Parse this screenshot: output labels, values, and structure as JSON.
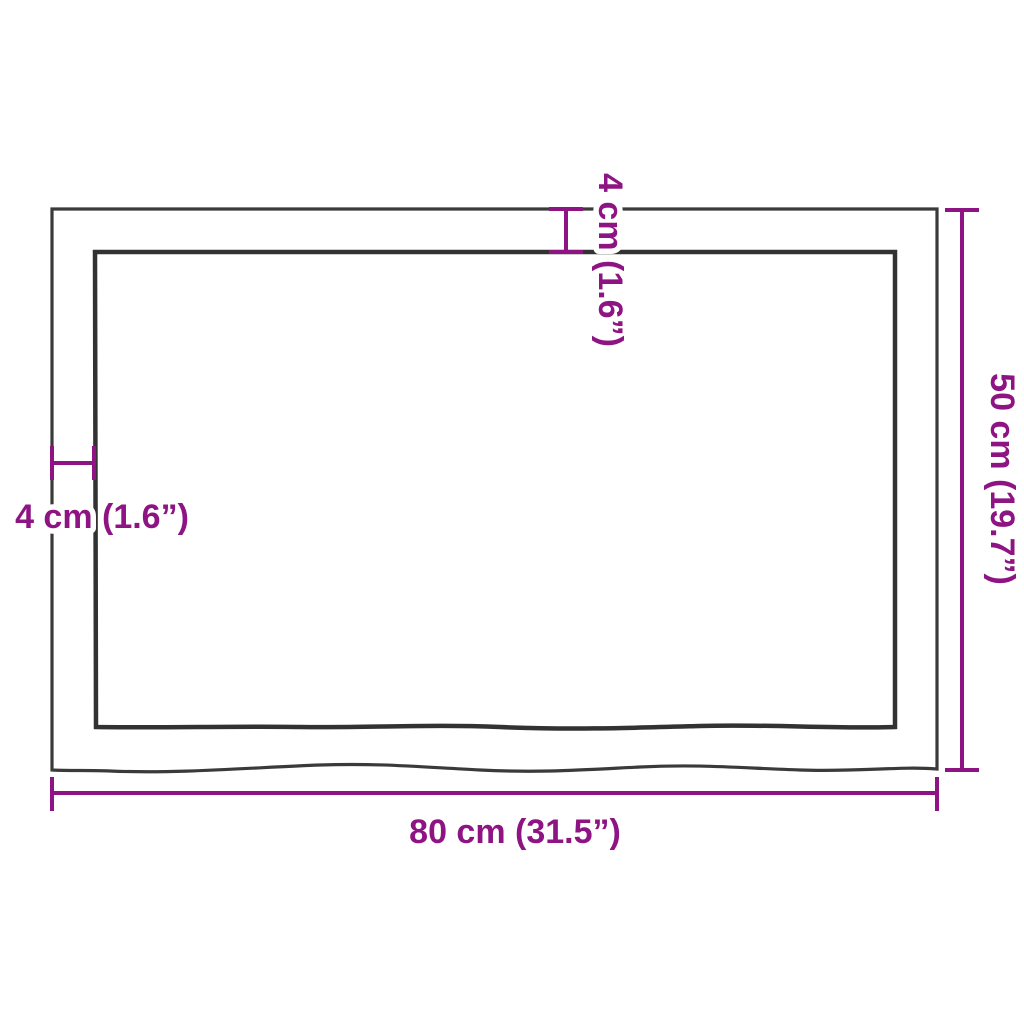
{
  "colors": {
    "background": "#ffffff",
    "outline": "#3a3a3a",
    "dimension_accent": "#8e1483",
    "text_halo": "#ffffff"
  },
  "dimensions": {
    "width": {
      "value_cm": 80,
      "value_inch": 31.5,
      "label": "80 cm (31.5”)"
    },
    "height": {
      "value_cm": 50,
      "value_inch": 19.7,
      "label": "50 cm (19.7”)"
    },
    "thickness_left": {
      "value_cm": 4,
      "value_inch": 1.6,
      "label": "4 cm (1.6”)"
    },
    "thickness_top": {
      "value_cm": 4,
      "value_inch": 1.6,
      "label": "4 cm (1.6”)"
    }
  }
}
